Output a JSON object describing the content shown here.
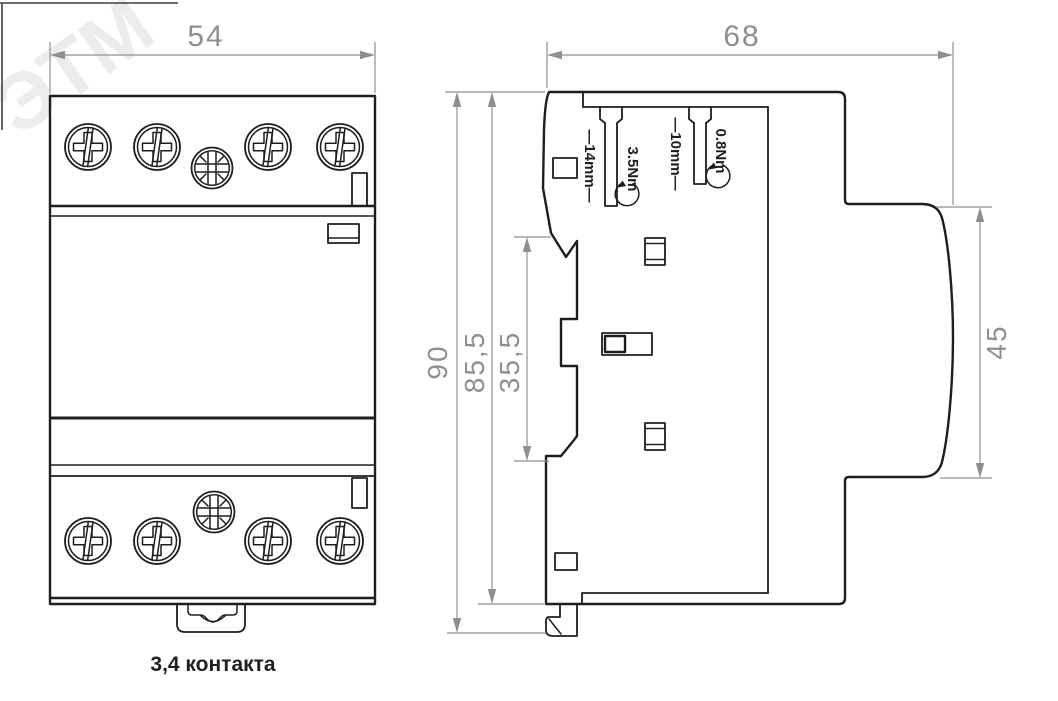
{
  "watermark": {
    "text": "ЭТМ"
  },
  "front_view": {
    "caption": "3,4 контакта",
    "dim_width": "54"
  },
  "side_view": {
    "dim_width": "68",
    "dim_height_total": "90",
    "dim_height_body": "85,5",
    "dim_din_channel": "35,5",
    "dim_front_height": "45",
    "label_strip_main": "—14mm—",
    "label_torque_main": "3.5Nm",
    "label_strip_aux": "—10mm—",
    "label_torque_aux": "0.8Nm"
  },
  "colors": {
    "outline": "#1e1e1e",
    "dimension": "#8f8f8f",
    "caption": "#1f1f1f",
    "watermark": "#ececec",
    "frame": "#3f3f3f",
    "bg": "#ffffff"
  }
}
